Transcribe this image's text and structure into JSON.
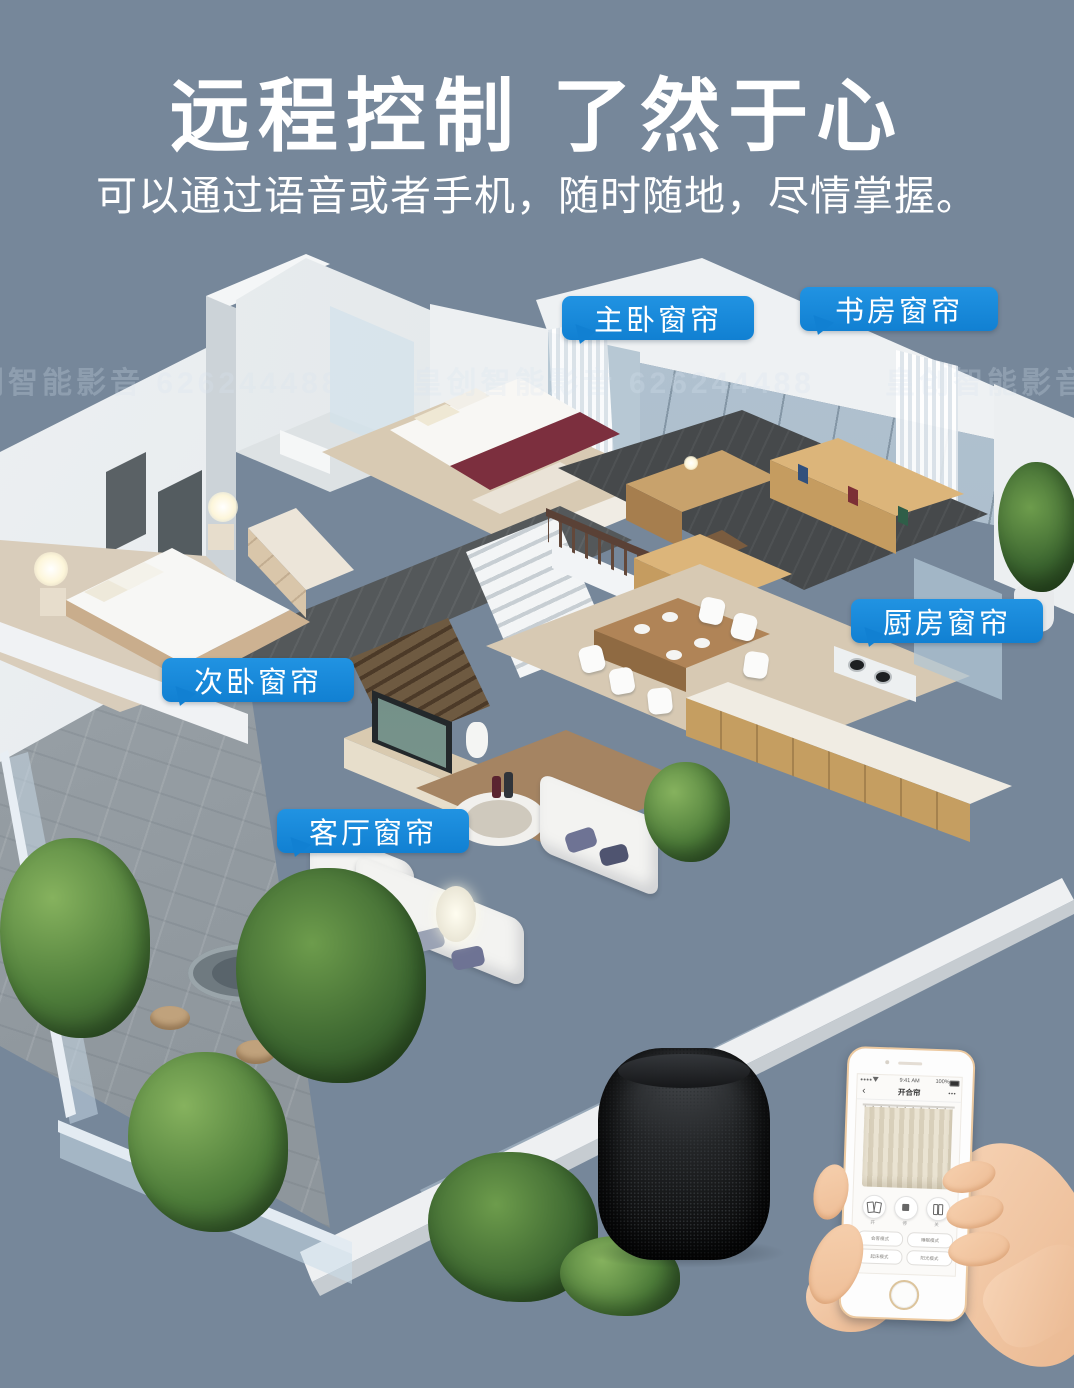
{
  "colors": {
    "background": "#76879A",
    "label_blue": "#1180D2"
  },
  "header": {
    "title": "远程控制 了然于心",
    "subtitle": "可以通过语音或者手机，随时随地，尽情掌握。"
  },
  "watermark": {
    "text": "皇创智能影音 626244488"
  },
  "callouts": {
    "master_bedroom": "主卧窗帘",
    "study": "书房窗帘",
    "kitchen": "厨房窗帘",
    "second_bedroom": "次卧窗帘",
    "living_room": "客厅窗帘"
  },
  "phone": {
    "status": {
      "time": "9:41 AM",
      "battery": "100%"
    },
    "nav": {
      "back": "‹",
      "title": "开合帘",
      "menu": "•••"
    },
    "controls": [
      {
        "label": "开"
      },
      {
        "label": "停"
      },
      {
        "label": "关"
      }
    ],
    "modes": [
      "会客模式",
      "睡眠模式",
      "起床模式",
      "阳光模式"
    ]
  }
}
